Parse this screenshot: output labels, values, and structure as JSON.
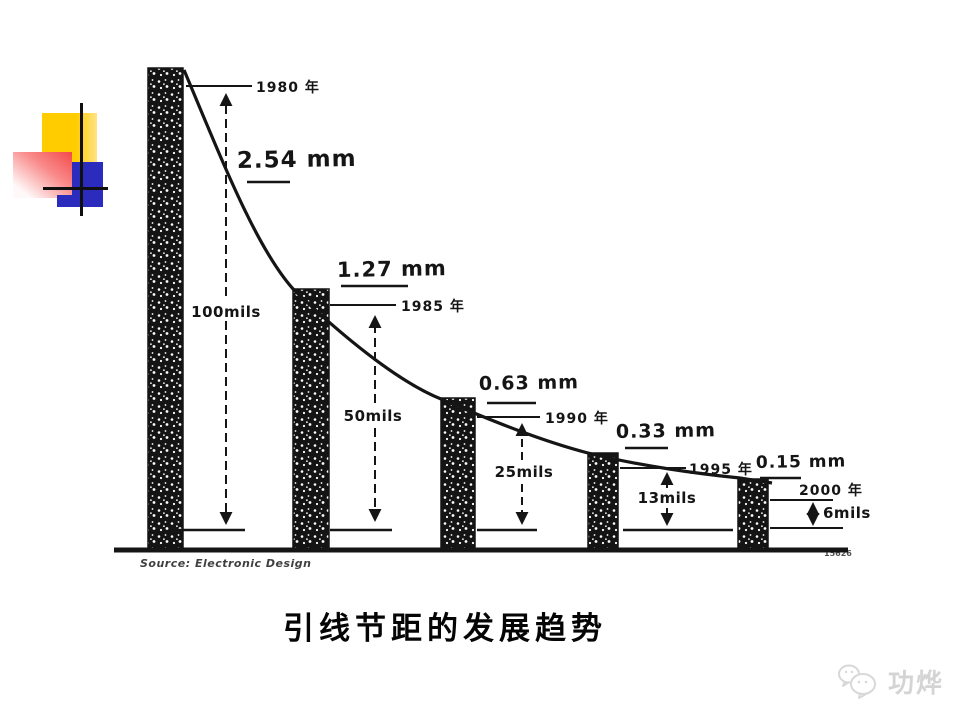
{
  "slide": {
    "caption": "引线节距的发展趋势",
    "watermark": "功烨"
  },
  "chart_data": {
    "type": "bar",
    "title": "引线节距的发展趋势",
    "source": "Source: Electronic Design",
    "figure_code": "15626",
    "categories": [
      "1980",
      "1985",
      "1990",
      "1995",
      "2000"
    ],
    "series": [
      {
        "name": "pitch_mm",
        "values": [
          2.54,
          1.27,
          0.63,
          0.33,
          0.15
        ]
      },
      {
        "name": "pitch_mils",
        "values": [
          100,
          50,
          25,
          13,
          6
        ]
      }
    ],
    "legend": "none",
    "grid": false,
    "points": [
      {
        "year_label": "1980 年",
        "mm_label": "2.54 mm",
        "mils_label": "100mils"
      },
      {
        "year_label": "1985 年",
        "mm_label": "1.27 mm",
        "mils_label": "50mils"
      },
      {
        "year_label": "1990 年",
        "mm_label": "0.63 mm",
        "mils_label": "25mils"
      },
      {
        "year_label": "1995 年",
        "mm_label": "0.33 mm",
        "mils_label": "13mils"
      },
      {
        "year_label": "2000 年",
        "mm_label": "0.15 mm",
        "mils_label": "6mils"
      }
    ],
    "colors": {
      "ink": "#151515",
      "logo_yellow": "#ffcc00",
      "logo_blue": "#2b2bbe",
      "logo_pink": "#f44a4a",
      "watermark_gray": "#d4d4d4"
    }
  }
}
